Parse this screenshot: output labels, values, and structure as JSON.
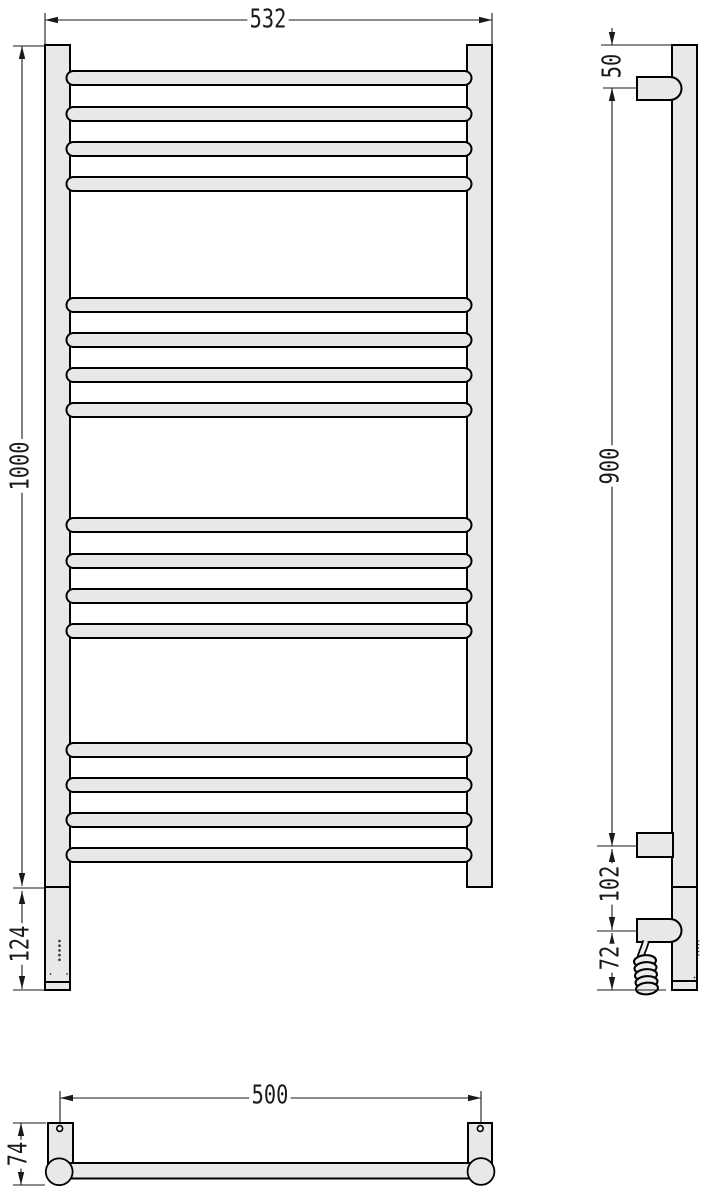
{
  "drawing": {
    "subject": "ladder towel rail radiator technical drawing (front, side and plan views)",
    "colors": {
      "fill": "#e8e8e8",
      "outline": "#000000",
      "dimension": "#1a1a1a",
      "background": "#ffffff"
    },
    "views": {
      "front": {
        "rung_count": 16,
        "rung_groups": 4,
        "dims": {
          "overall_width": "532",
          "overall_height": "1000",
          "bottom_extension": "124"
        }
      },
      "side": {
        "dims": {
          "top_to_bracket": "50",
          "bracket_span": "900",
          "lower_bracket_gap": "102",
          "bottom_gap": "72"
        }
      },
      "plan": {
        "dims": {
          "bracket_spacing": "500",
          "depth": "74"
        }
      }
    },
    "labels": {
      "front_width": "532",
      "front_height": "1000",
      "front_extension": "124",
      "side_top_offset": "50",
      "side_span": "900",
      "side_lower_gap": "102",
      "side_bottom_gap": "72",
      "plan_span": "500",
      "plan_depth": "74"
    }
  }
}
